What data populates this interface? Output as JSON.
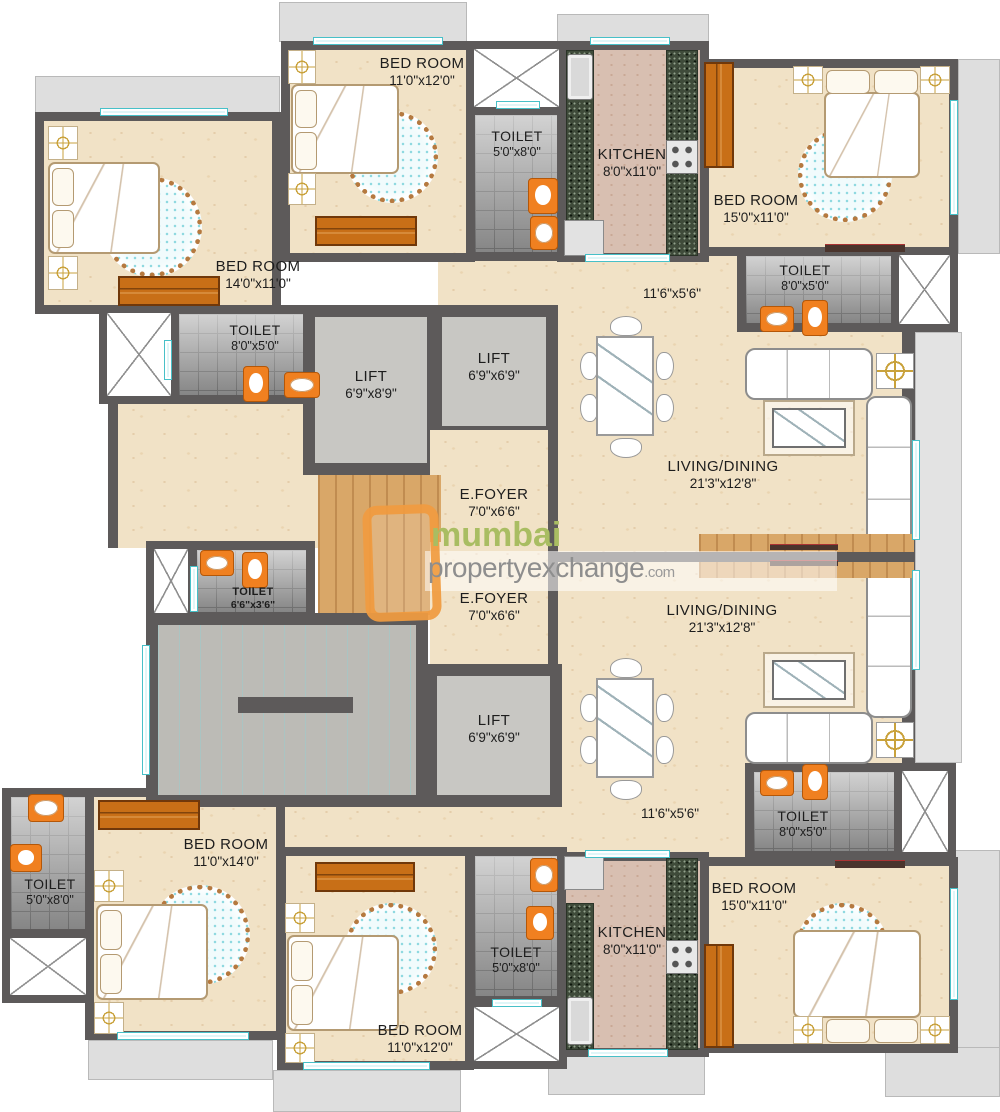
{
  "watermark": {
    "brand": "mumbai",
    "domain": "propertyexchange",
    "tld": ".com"
  },
  "colors": {
    "wall": "#5d5a5a",
    "floor_beige": "#f1e2c6",
    "tile_gray": "#9d9d9d",
    "furniture_orange": "#c86f17",
    "fixture_orange": "#f08020",
    "granite_green": "#3f4b3a",
    "window_cyan": "#dff6f8",
    "balcony_gray": "#dedede",
    "brand_green": "#a9bd62",
    "brand_gray": "#8e8e8e",
    "brand_orange": "#f09a3e"
  },
  "rooms": {
    "bedroom_tl": {
      "name": "BED ROOM",
      "dim": "11'0\"x12'0\""
    },
    "toilet_t": {
      "name": "TOILET",
      "dim": "5'0\"x8'0\""
    },
    "kitchen_t": {
      "name": "KITCHEN",
      "dim": "8'0\"x11'0\""
    },
    "bedroom_tr": {
      "name": "BED ROOM",
      "dim": "15'0\"x11'0\""
    },
    "toilet_tr": {
      "name": "TOILET",
      "dim": "8'0\"x5'0\""
    },
    "bedroom_l": {
      "name": "BED ROOM",
      "dim": "14'0\"x11'0\""
    },
    "toilet_l": {
      "name": "TOILET",
      "dim": "8'0\"x5'0\""
    },
    "lift_a": {
      "name": "LIFT",
      "dim": "6'9\"x8'9\""
    },
    "lift_b": {
      "name": "LIFT",
      "dim": "6'9\"x6'9\""
    },
    "lift_c": {
      "name": "LIFT",
      "dim": "6'9\"x6'9\""
    },
    "efoyer_t": {
      "name": "E.FOYER",
      "dim": "7'0\"x6'6\""
    },
    "efoyer_b": {
      "name": "E.FOYER",
      "dim": "7'0\"x6'6\""
    },
    "toilet_m": {
      "name": "TOILET",
      "dim": "6'6\"x3'6\""
    },
    "living_t": {
      "name": "LIVING/DINING",
      "dim": "21'3\"x12'8\""
    },
    "living_b": {
      "name": "LIVING/DINING",
      "dim": "21'3\"x12'8\""
    },
    "passage_t": {
      "dim": "11'6\"x5'6\""
    },
    "passage_b": {
      "dim": "11'6\"x5'6\""
    },
    "toilet_br": {
      "name": "TOILET",
      "dim": "8'0\"x5'0\""
    },
    "bedroom_bl": {
      "name": "BED ROOM",
      "dim": "11'0\"x14'0\""
    },
    "toilet_bl": {
      "name": "TOILET",
      "dim": "5'0\"x8'0\""
    },
    "bedroom_bm": {
      "name": "BED ROOM",
      "dim": "11'0\"x12'0\""
    },
    "toilet_bm": {
      "name": "TOILET",
      "dim": "5'0\"x8'0\""
    },
    "kitchen_b": {
      "name": "KITCHEN",
      "dim": "8'0\"x11'0\""
    },
    "bedroom_br": {
      "name": "BED ROOM",
      "dim": "15'0\"x11'0\""
    }
  }
}
